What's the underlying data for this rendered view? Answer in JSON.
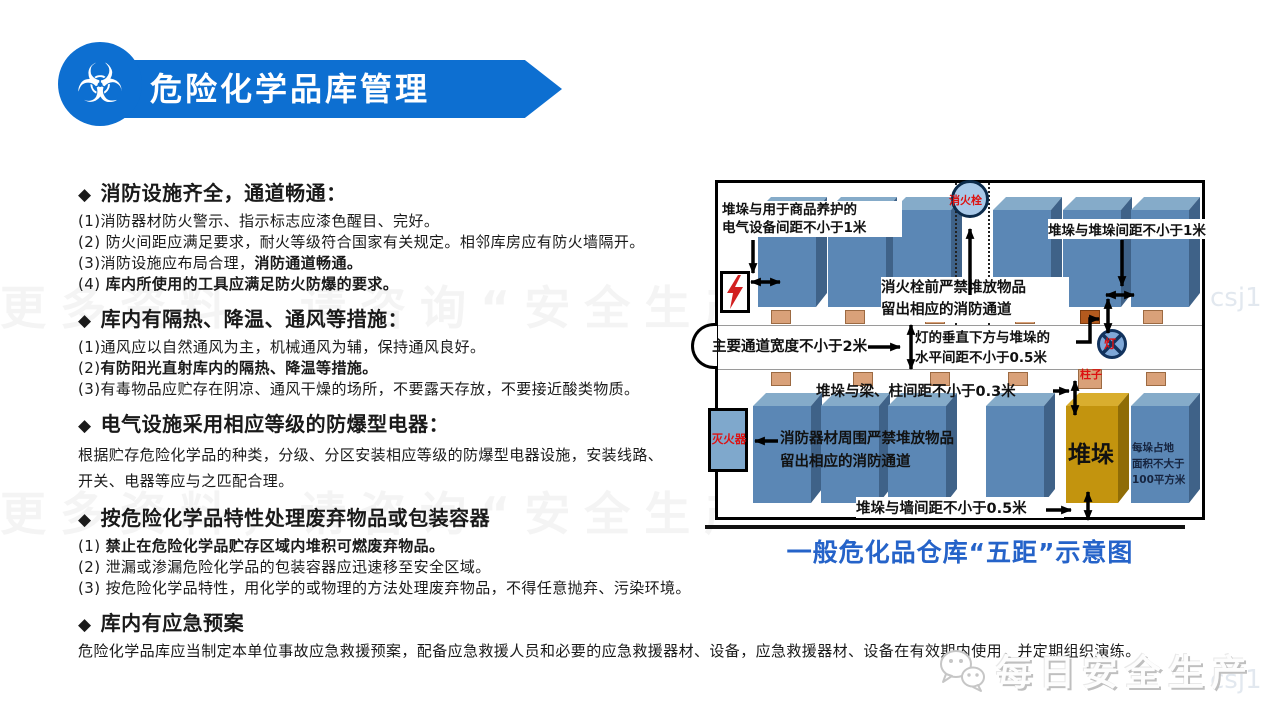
{
  "header": {
    "title": "危险化学品库管理",
    "icon_glyph": "☣"
  },
  "bullet": "◆",
  "sections": [
    {
      "heading": "消防设施齐全，通道畅通：",
      "lines": [
        [
          {
            "t": "(1)消防器材防火警示、指示标志应漆色醒目、完好。",
            "b": false
          }
        ],
        [
          {
            "t": "(2) 防火间距应满足要求，耐火等级符合国家有关规定。相邻库房应有防火墙隔开。",
            "b": false
          }
        ],
        [
          {
            "t": "(3)消防设施应布局合理，",
            "b": false
          },
          {
            "t": "消防通道畅通。",
            "b": true
          }
        ],
        [
          {
            "t": "(4) ",
            "b": false
          },
          {
            "t": "库内所使用的工具应满足防火防爆的要求。",
            "b": true
          }
        ]
      ]
    },
    {
      "heading": "库内有隔热、降温、通风等措施：",
      "lines": [
        [
          {
            "t": "(1)通风应以自然通风为主，机械通风为辅，保持通风良好。",
            "b": false
          }
        ],
        [
          {
            "t": "(2)",
            "b": false
          },
          {
            "t": "有防阳光直射库内的隔热、降温等措施。",
            "b": true
          }
        ],
        [
          {
            "t": "(3)有毒物品应贮存在阴凉、通风干燥的场所，不要露天存放，不要接近酸类物质。",
            "b": false
          }
        ]
      ]
    },
    {
      "heading": "电气设施采用相应等级的防爆型电器：",
      "lines": [
        [
          {
            "t": "根据贮存危险化学品的种类，分级、分区安装相应等级的防爆型电器设施，安装线路、",
            "b": false
          }
        ],
        [
          {
            "t": "开关、电器等应与之匹配合理。",
            "b": false
          }
        ]
      ]
    },
    {
      "heading": "按危险化学品特性处理废弃物品或包装容器",
      "lines": [
        [
          {
            "t": "(1) ",
            "b": false
          },
          {
            "t": "禁止在危险化学品贮存区域内堆积可燃废弃物品。",
            "b": true
          }
        ],
        [
          {
            "t": "(2) 泄漏或渗漏危险化学品的包装容器应迅速移至安全区域。",
            "b": false
          }
        ],
        [
          {
            "t": "(3) 按危险化学品特性，用化学的或物理的方法处理废弃物品，不得任意抛弃、污染环境。",
            "b": false
          }
        ]
      ]
    },
    {
      "heading": "库内有应急预案",
      "lines": [
        [
          {
            "t": "危险化学品库应当制定本单位事故应急救援预案，配备应急救援人员和必要的应急救援器材、设备，应急救援器材、设备在有效期内使用，并定期组织演练。",
            "b": false
          }
        ]
      ]
    }
  ],
  "diagram": {
    "caption": "一般危化品仓库“五距”示意图",
    "labels": {
      "stack_electric": "堆垛与用于商品养护的\n电气设备间距不小于1米",
      "hydrant": "消火栓",
      "hydrant_rule": "消火栓前严禁堆放物品\n留出相应的消防通道",
      "stack_stack": "堆垛与堆垛间距不小于1米",
      "aisle": "主要通道宽度不小于2米",
      "lamp_rule": "灯的垂直下方与堆垛的\n水平间距不小于0.5米",
      "lamp": "灯",
      "pillar": "柱子",
      "beam_rule": "堆垛与梁、柱间距不小于0.3米",
      "extinguisher": "灭火器",
      "fire_equipment_rule": "消防器材周围严禁堆放物品\n留出相应的消防通道",
      "stack": "堆垛",
      "area_rule": "每垛占地\n面积不大于\n100平方米",
      "wall_rule": "堆垛与墙间距不小于0.5米"
    }
  },
  "watermark": {
    "row": "更多资料，请咨询“安全生产”",
    "side": "csj1"
  },
  "footer_logo": {
    "text": "每日安全生产"
  },
  "colors": {
    "banner_blue": "#0d6fd1",
    "caption_blue": "#2563c9",
    "box_blue_front": "#5b87b5",
    "box_blue_top": "#85abc9",
    "box_blue_side": "#3f6288",
    "gold_front": "#c3940e",
    "gold_top": "#d9ae2e",
    "gold_side": "#8f6c06",
    "lamp_tan": "#d9a179",
    "lamp_dark": "#b35a1e",
    "red_label": "#dd1111"
  }
}
